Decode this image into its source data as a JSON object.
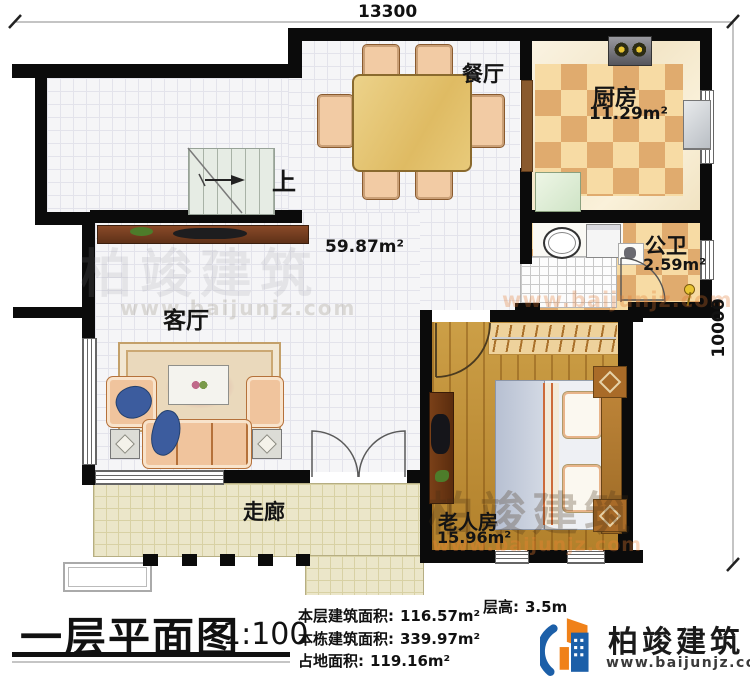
{
  "dims": {
    "width": "13300",
    "height": "10000"
  },
  "rooms": {
    "dining": {
      "name": "餐厅"
    },
    "kitchen": {
      "name": "厨房",
      "area": "11.29m²"
    },
    "bath": {
      "name": "公卫",
      "area": "2.59m²"
    },
    "living": {
      "name": "客厅"
    },
    "corridor": {
      "name": "走廊"
    },
    "bedroom": {
      "name": "老人房",
      "area": "15.96m²"
    },
    "hall_area": "59.87m²",
    "stairs_up": "上"
  },
  "title": {
    "text": "一层平面图",
    "scale": "1:100"
  },
  "stats": {
    "floor": {
      "label": "本层建筑面积:",
      "value": "116.57m²"
    },
    "building": {
      "label": "本栋建筑面积:",
      "value": "339.97m²"
    },
    "land": {
      "label": "占地面积:",
      "value": "119.16m²"
    },
    "height": {
      "label": "层高:",
      "value": "3.5m"
    }
  },
  "brand": {
    "name": "柏竣建筑",
    "site": "www.baijunjz.com"
  },
  "colors": {
    "wall": "#0b0b0b",
    "accent_blue": "#1c5fa8",
    "accent_orange": "#f08119"
  }
}
